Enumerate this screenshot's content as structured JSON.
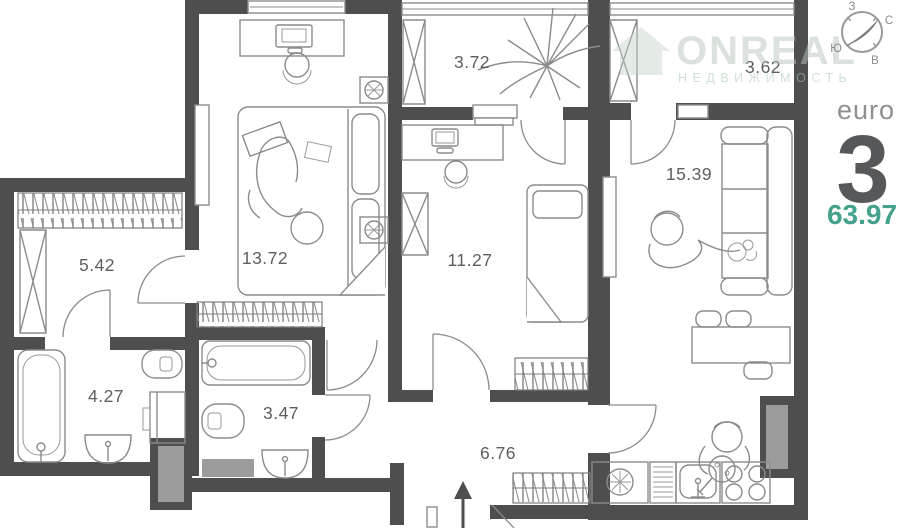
{
  "plan": {
    "rooms": [
      {
        "name": "bedroom",
        "area": "13.72"
      },
      {
        "name": "wardrobe",
        "area": "5.42"
      },
      {
        "name": "bathroom",
        "area": "4.27"
      },
      {
        "name": "bathroom-2",
        "area": "3.47"
      },
      {
        "name": "hallway",
        "area": "6.76"
      },
      {
        "name": "bedroom-2",
        "area": "11.27"
      },
      {
        "name": "balcony",
        "area": "3.72"
      },
      {
        "name": "balcony-2",
        "area": "3.62"
      },
      {
        "name": "living-kitchen",
        "area": "15.39"
      }
    ]
  },
  "compass": {
    "north": "С",
    "south": "Ю",
    "west": "З",
    "east": "В"
  },
  "apartment": {
    "type_label": "euro",
    "rooms_count": "3",
    "total_area": "63.97",
    "accent_color": "#44a18b"
  },
  "watermark": {
    "brand": "ONREAL",
    "tagline": "НЕДВИЖИМОСТЬ"
  },
  "colors": {
    "wall": "#4e4e4e",
    "furniture_line": "#8b8b8b",
    "vent_fill": "#9c9c9c"
  }
}
